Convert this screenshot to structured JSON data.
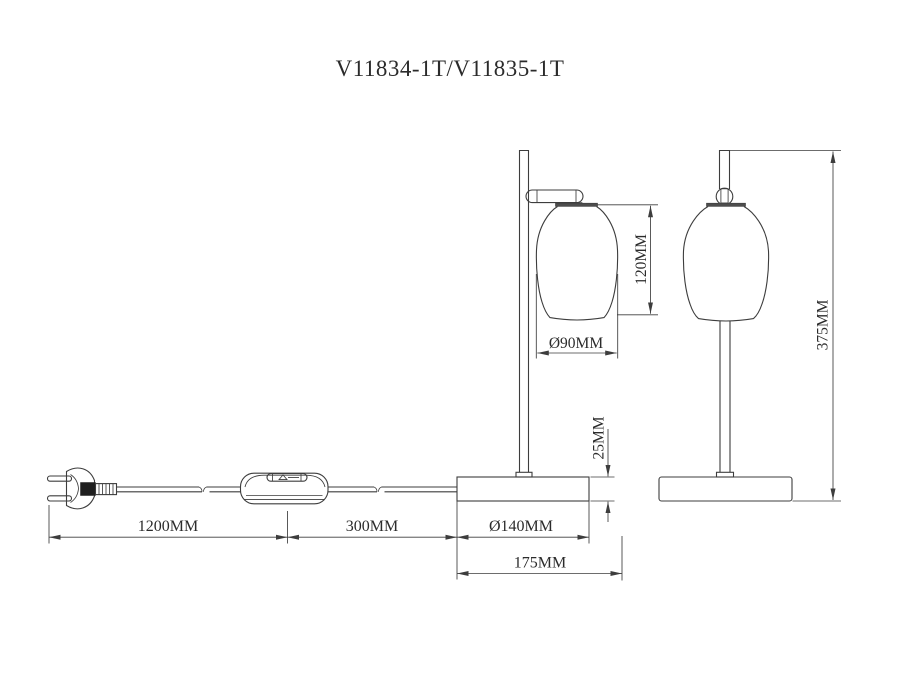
{
  "title": "V11834-1T/V11835-1T",
  "drawing": {
    "type": "technical-dimension-drawing",
    "subject": "table lamp, front view and side view, with power cord, plug and inline switch",
    "dimensions": {
      "shade_height": "120MM",
      "shade_diameter": "Ø90MM",
      "base_height": "25MM",
      "cord_plug_to_switch": "1200MM",
      "cord_switch_to_base": "300MM",
      "base_diameter": "Ø140MM",
      "base_depth": "175MM",
      "total_height": "375MM"
    },
    "colors": {
      "background": "#ffffff",
      "line": "#3d3d3d",
      "text": "#2b2b2b",
      "dark_fill": "#4d4d4d"
    }
  }
}
